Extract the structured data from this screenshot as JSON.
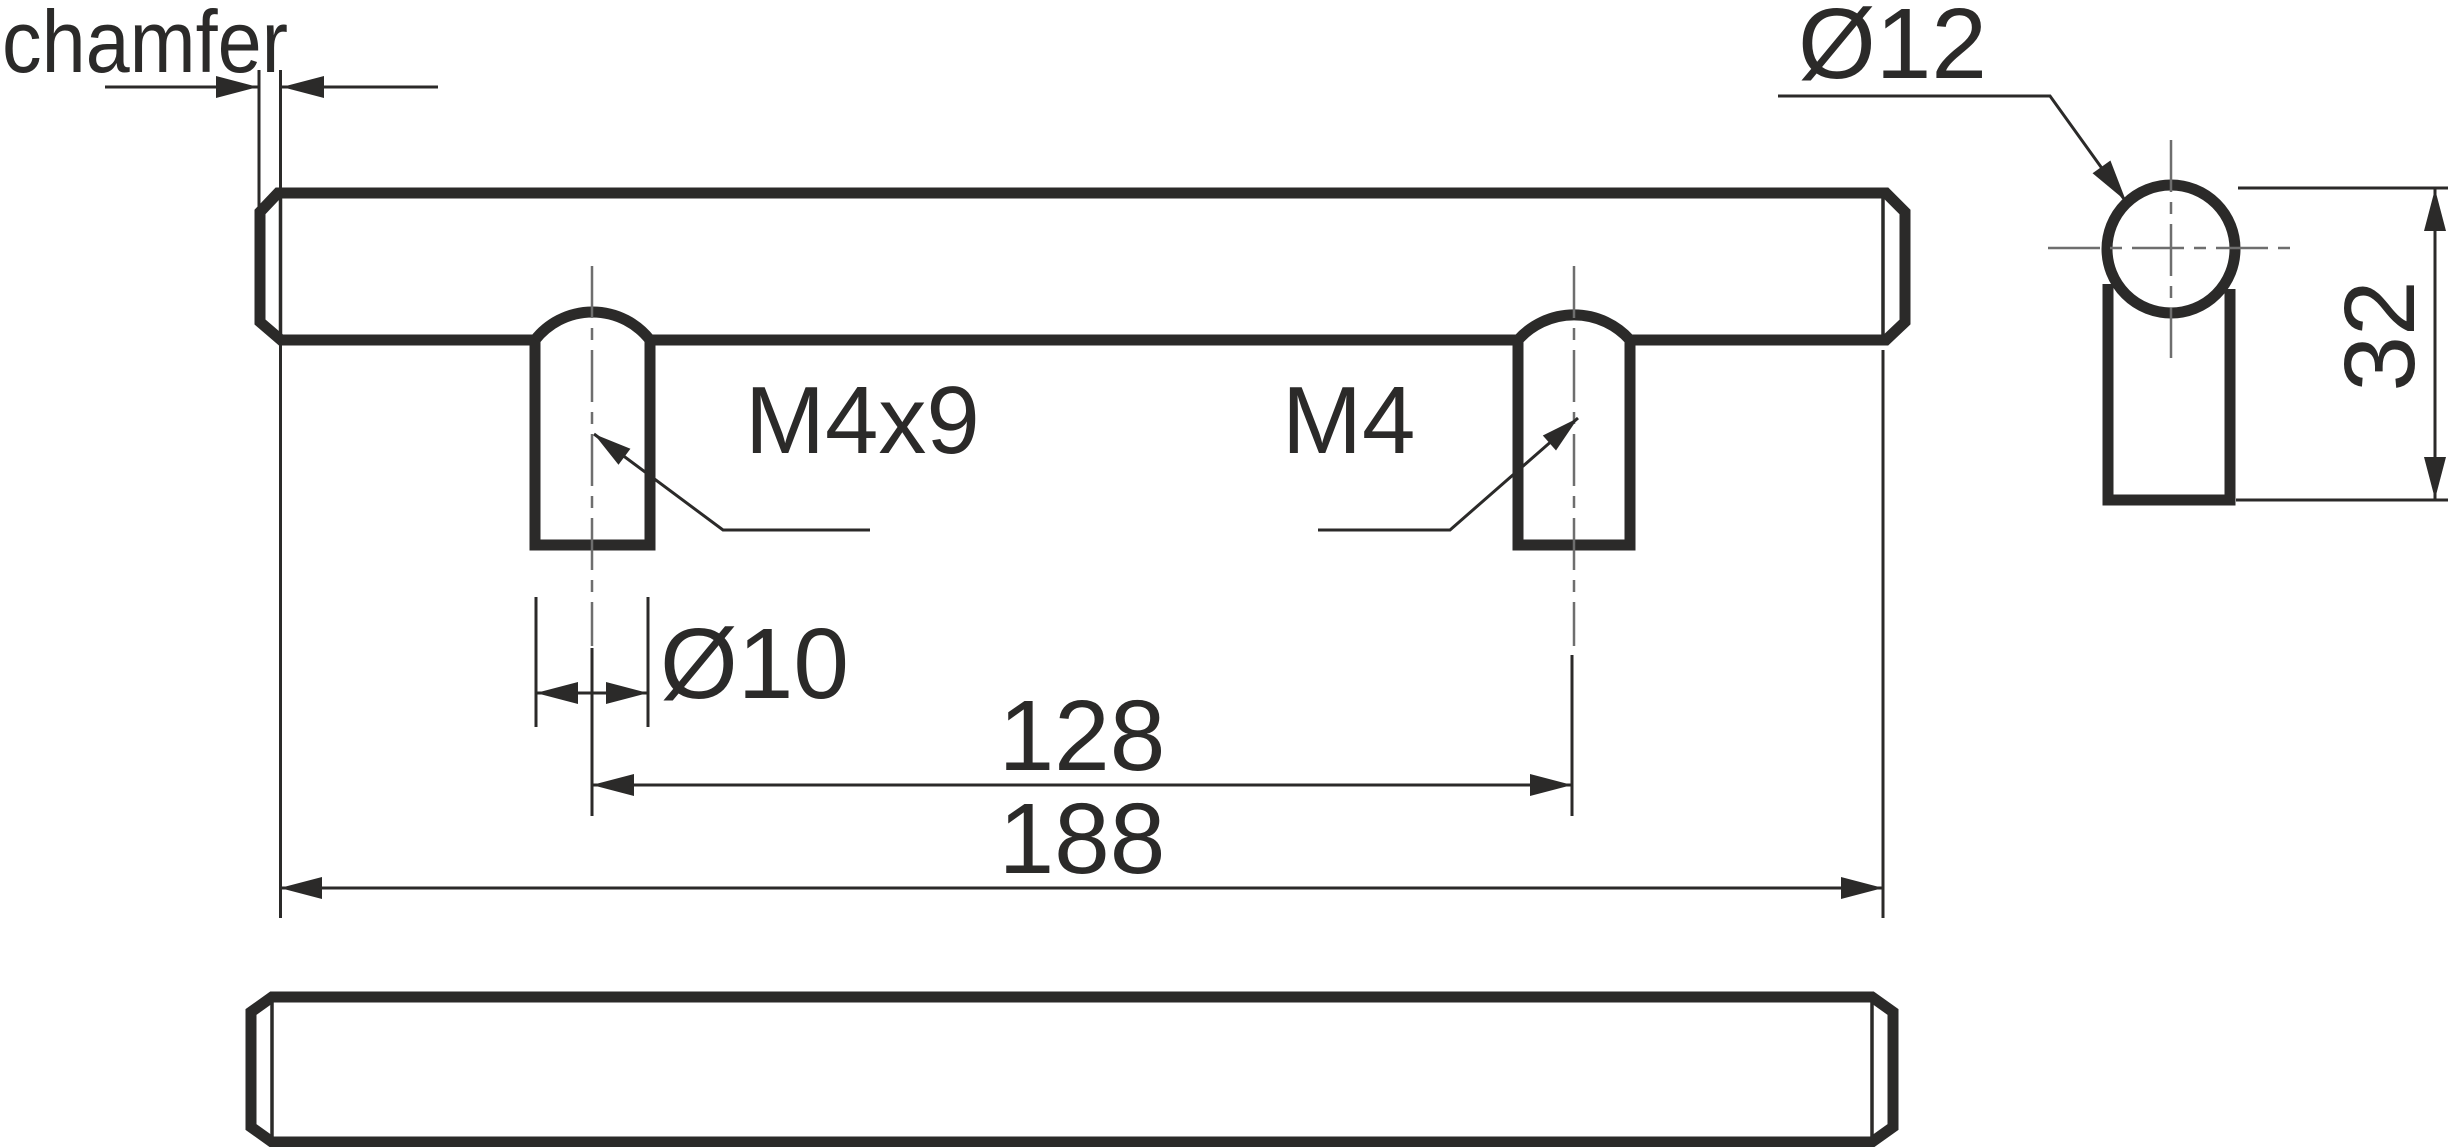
{
  "drawing": {
    "type": "technical-drawing",
    "subject": "cabinet bar handle, three orthographic views",
    "labels": {
      "chamfer_note": "chamfer",
      "thread_callout_front_post": "M4x9",
      "thread_callout_rear_post": "M4",
      "post_diameter": "Ø10",
      "bar_diameter": "Ø12",
      "hole_spacing": "128",
      "overall_length": "188",
      "overall_height": "32"
    },
    "dimension_values": {
      "hole_spacing_mm": 128,
      "overall_length_mm": 188,
      "overall_height_mm": 32,
      "post_diameter_mm": 10,
      "bar_diameter_mm": 12,
      "thread_front": "M4x9",
      "thread_rear": "M4"
    },
    "colors": {
      "line": "#2b2a29",
      "centerline": "#6e6e6e",
      "background": "#ffffff"
    }
  }
}
